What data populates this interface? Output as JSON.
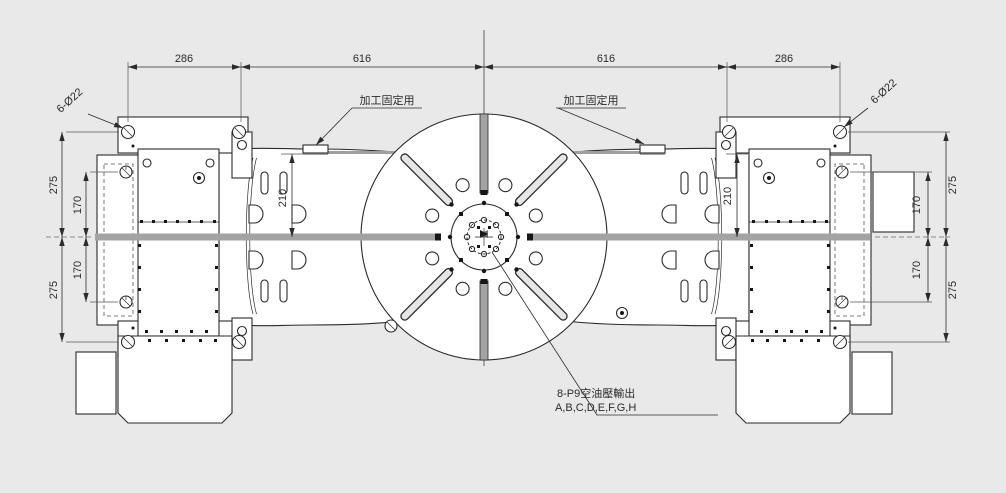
{
  "drawing": {
    "type": "technical_drawing_top_view_tilting_rotary_table",
    "colors": {
      "background": "#e9e9e9",
      "line": "#2b2b2b",
      "body_fill": "#ffffff",
      "slot_gray": "#a3a3a3"
    },
    "dims": {
      "top": [
        "286",
        "616",
        "616",
        "286"
      ],
      "left": {
        "outer_top": "275",
        "inner_top": "170",
        "inner_bottom": "170",
        "outer_bottom": "275"
      },
      "right": {
        "outer_top": "275",
        "inner_top": "170",
        "inner_bottom": "170",
        "outer_bottom": "275"
      },
      "slot_left": "210",
      "slot_right": "210"
    },
    "labels": {
      "fixture_left": "加工固定用",
      "fixture_right": "加工固定用",
      "bolt_left": "6-Ø22",
      "bolt_right": "6-Ø22",
      "ports_line1": "8-P9空油壓輸出",
      "ports_line2": "A,B,C,D,E,F,G,H"
    }
  }
}
